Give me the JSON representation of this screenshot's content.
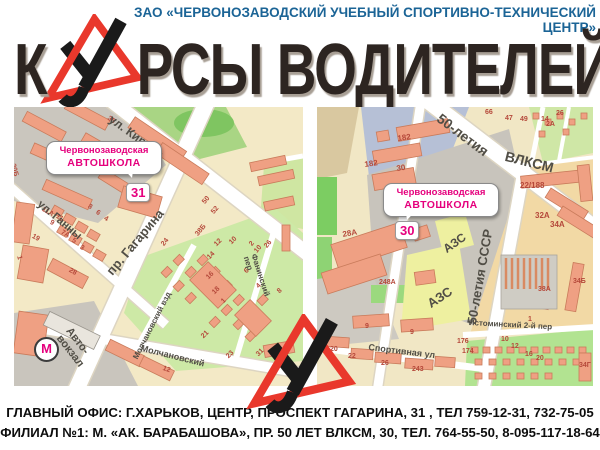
{
  "org_header": {
    "text": "ЗАО «ЧЕРВОНОЗАВОДСКИЙ УЧЕБНЫЙ СПОРТИВНО-ТЕХНИЧЕСКИЙ ЦЕНТР»"
  },
  "title": {
    "before_logo": "К",
    "after_logo": "РСЫ ВОДИТЕЛЕЙ"
  },
  "colors": {
    "header_blue": "#1b6496",
    "title_dark": "#2d2521",
    "logo_red": "#e9382c",
    "logo_black": "#1a1a1a",
    "accent_magenta": "#e5007d",
    "building_salmon": "#efa083",
    "map_cream": "#f3e9c6",
    "park_green": "#cde9a6",
    "number_red": "#b5483a"
  },
  "left_map": {
    "callout": {
      "line1": "Червонозаводская",
      "line2": "АВТОШКОЛА"
    },
    "marker": "31",
    "metro_label": "М",
    "streets": [
      {
        "t": "ул. Кирова",
        "x": 100,
        "y": 6,
        "r": 36,
        "s": 12
      },
      {
        "t": "ул. Ганны",
        "x": 28,
        "y": 92,
        "r": 40,
        "s": 11
      },
      {
        "t": "пр. Гагарина",
        "x": 90,
        "y": 162,
        "r": -50,
        "s": 13
      },
      {
        "t": "Молчановский взд",
        "x": 118,
        "y": 250,
        "r": -63,
        "s": 8
      },
      {
        "t": "Молчановский",
        "x": 128,
        "y": 237,
        "r": 14,
        "s": 9
      },
      {
        "t": "Фанинский пер",
        "x": 243,
        "y": 146,
        "r": 72,
        "s": 8
      },
      {
        "t": "Авто-\nвокзал",
        "x": 58,
        "y": 219,
        "r": 52,
        "s": 11
      }
    ],
    "numbers": [
      {
        "t": "35",
        "x": 96,
        "y": 8,
        "r": 36
      },
      {
        "t": "35",
        "x": 140,
        "y": 46,
        "r": 36
      },
      {
        "t": "20Б",
        "x": 2,
        "y": 56,
        "r": 75
      },
      {
        "t": "11А",
        "x": 30,
        "y": 99,
        "r": 30
      },
      {
        "t": "11",
        "x": 44,
        "y": 106,
        "r": 30
      },
      {
        "t": "9",
        "x": 38,
        "y": 112,
        "r": 30
      },
      {
        "t": "19",
        "x": 20,
        "y": 126,
        "r": 30
      },
      {
        "t": "7А",
        "x": 49,
        "y": 122,
        "r": 30
      },
      {
        "t": "5",
        "x": 60,
        "y": 130,
        "r": 30
      },
      {
        "t": "3",
        "x": 68,
        "y": 137,
        "r": 30
      },
      {
        "t": "8",
        "x": 76,
        "y": 96,
        "r": 30
      },
      {
        "t": "6",
        "x": 84,
        "y": 102,
        "r": 30
      },
      {
        "t": "4",
        "x": 92,
        "y": 108,
        "r": 30
      },
      {
        "t": "1",
        "x": 8,
        "y": 148,
        "r": 75
      },
      {
        "t": "28",
        "x": 57,
        "y": 160,
        "r": 30
      },
      {
        "t": "24",
        "x": 146,
        "y": 136,
        "r": -50
      },
      {
        "t": "38Б",
        "x": 180,
        "y": 126,
        "r": -50
      },
      {
        "t": "50",
        "x": 187,
        "y": 94,
        "r": -50
      },
      {
        "t": "52",
        "x": 196,
        "y": 104,
        "r": -50
      },
      {
        "t": "2",
        "x": 234,
        "y": 136,
        "r": -50
      },
      {
        "t": "10",
        "x": 239,
        "y": 143,
        "r": -50
      },
      {
        "t": "26",
        "x": 249,
        "y": 138,
        "r": -50
      },
      {
        "t": "12",
        "x": 199,
        "y": 136,
        "r": -45
      },
      {
        "t": "14",
        "x": 192,
        "y": 149,
        "r": -45
      },
      {
        "t": "16",
        "x": 191,
        "y": 169,
        "r": -45
      },
      {
        "t": "18",
        "x": 197,
        "y": 184,
        "r": -45
      },
      {
        "t": "10",
        "x": 214,
        "y": 134,
        "r": -45
      },
      {
        "t": "6",
        "x": 229,
        "y": 163,
        "r": -45
      },
      {
        "t": "4",
        "x": 241,
        "y": 178,
        "r": -45
      },
      {
        "t": "8",
        "x": 262,
        "y": 183,
        "r": -45
      },
      {
        "t": "1",
        "x": 206,
        "y": 193,
        "r": -45
      },
      {
        "t": "21",
        "x": 186,
        "y": 228,
        "r": -45
      },
      {
        "t": "23",
        "x": 211,
        "y": 248,
        "r": -45
      },
      {
        "t": "31",
        "x": 241,
        "y": 246,
        "r": -45
      },
      {
        "t": "12",
        "x": 150,
        "y": 258,
        "r": 20
      }
    ]
  },
  "right_map": {
    "callout": {
      "line1": "Червонозаводская",
      "line2": "АВТОШКОЛА"
    },
    "marker": "30",
    "streets": [
      {
        "t": "50-летия",
        "x": 126,
        "y": 4,
        "r": 37,
        "s": 14
      },
      {
        "t": "ВЛКСМ",
        "x": 190,
        "y": 42,
        "r": 14,
        "s": 14
      },
      {
        "t": "50-летия СССР",
        "x": 148,
        "y": 216,
        "r": -80,
        "s": 13
      },
      {
        "t": "Истоминский 2-й пер",
        "x": 152,
        "y": 212,
        "r": 3,
        "s": 8
      },
      {
        "t": "Спортивная ул",
        "x": 52,
        "y": 236,
        "r": 7,
        "s": 9
      },
      {
        "t": "АЗС",
        "x": 124,
        "y": 138,
        "r": -35,
        "s": 12
      },
      {
        "t": "АЗС",
        "x": 108,
        "y": 192,
        "r": -33,
        "s": 13
      }
    ],
    "numbers": [
      {
        "t": "182",
        "x": 80,
        "y": 28,
        "r": -8,
        "s": 8
      },
      {
        "t": "182",
        "x": 47,
        "y": 54,
        "r": -8,
        "s": 8
      },
      {
        "t": "30",
        "x": 79,
        "y": 58,
        "r": -8,
        "s": 8
      },
      {
        "t": "28А",
        "x": 25,
        "y": 124,
        "r": -10,
        "s": 8
      },
      {
        "t": "22/188",
        "x": 203,
        "y": 75,
        "r": 0,
        "s": 8
      },
      {
        "t": "32А",
        "x": 218,
        "y": 105,
        "r": 0,
        "s": 8
      },
      {
        "t": "34А",
        "x": 233,
        "y": 114,
        "r": 0,
        "s": 8
      },
      {
        "t": "66",
        "x": 168,
        "y": 2,
        "r": 0
      },
      {
        "t": "47",
        "x": 188,
        "y": 8,
        "r": 0
      },
      {
        "t": "49",
        "x": 203,
        "y": 9,
        "r": 0
      },
      {
        "t": "14",
        "x": 224,
        "y": 9,
        "r": 0
      },
      {
        "t": "26",
        "x": 239,
        "y": 3,
        "r": 0
      },
      {
        "t": "2А",
        "x": 229,
        "y": 14,
        "r": 0
      },
      {
        "t": "248А",
        "x": 62,
        "y": 172,
        "r": 0
      },
      {
        "t": "9",
        "x": 48,
        "y": 216,
        "r": 0
      },
      {
        "t": "9",
        "x": 93,
        "y": 222,
        "r": 0
      },
      {
        "t": "20",
        "x": 13,
        "y": 239,
        "r": 0
      },
      {
        "t": "22",
        "x": 31,
        "y": 246,
        "r": 0
      },
      {
        "t": "26",
        "x": 64,
        "y": 253,
        "r": 0
      },
      {
        "t": "243",
        "x": 95,
        "y": 259,
        "r": 0
      },
      {
        "t": "176",
        "x": 140,
        "y": 231,
        "r": 0
      },
      {
        "t": "174",
        "x": 145,
        "y": 241,
        "r": 0
      },
      {
        "t": "1",
        "x": 211,
        "y": 209,
        "r": 0
      },
      {
        "t": "38А",
        "x": 221,
        "y": 179,
        "r": 0
      },
      {
        "t": "34Б",
        "x": 256,
        "y": 171,
        "r": 0
      },
      {
        "t": "34Г",
        "x": 262,
        "y": 255,
        "r": 0
      },
      {
        "t": "10",
        "x": 184,
        "y": 229,
        "r": 0
      },
      {
        "t": "12",
        "x": 194,
        "y": 236,
        "r": 0
      },
      {
        "t": "16",
        "x": 208,
        "y": 244,
        "r": 0
      },
      {
        "t": "20",
        "x": 219,
        "y": 248,
        "r": 0
      }
    ]
  },
  "footer": {
    "line1": "ГЛАВНЫЙ ОФИС:  Г.ХАРЬКОВ, ЦЕНТР, ПРОСПЕКТ ГАГАРИНА, 31 , ТЕЛ 759-12-31, 732-75-05",
    "line2": "ФИЛИАЛ №1:  М. «АК. БАРАБАШОВА», ПР. 50 ЛЕТ ВЛКСМ, 30, ТЕЛ. 764-55-50, 8-095-117-18-64"
  }
}
